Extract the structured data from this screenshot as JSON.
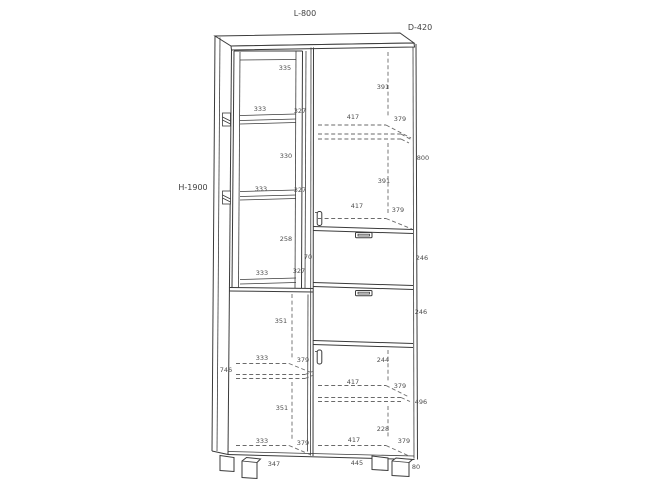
{
  "colors": {
    "line": "#3b3b3b",
    "dash": "#6a6a6a",
    "text": "#4d4d4d",
    "background": "#ffffff"
  },
  "drawing": {
    "type": "furniture cabinet technical drawing",
    "overall": {
      "width_label": "L-800",
      "depth_label": "D-420",
      "height_label": "H-1900"
    }
  },
  "dim_labels": [
    {
      "t": "335",
      "x": 285,
      "y": 68
    },
    {
      "t": "333",
      "x": 260,
      "y": 109
    },
    {
      "t": "327",
      "x": 300,
      "y": 111
    },
    {
      "t": "330",
      "x": 286,
      "y": 156
    },
    {
      "t": "333",
      "x": 261,
      "y": 189
    },
    {
      "t": "327",
      "x": 300,
      "y": 190
    },
    {
      "t": "258",
      "x": 286,
      "y": 239
    },
    {
      "t": "333",
      "x": 262,
      "y": 273
    },
    {
      "t": "327",
      "x": 299,
      "y": 271
    },
    {
      "t": "70",
      "x": 308,
      "y": 257
    },
    {
      "t": "351",
      "x": 281,
      "y": 321
    },
    {
      "t": "333",
      "x": 262,
      "y": 358
    },
    {
      "t": "379",
      "x": 303,
      "y": 360
    },
    {
      "t": "746",
      "x": 226,
      "y": 370
    },
    {
      "t": "351",
      "x": 282,
      "y": 408
    },
    {
      "t": "333",
      "x": 262,
      "y": 441
    },
    {
      "t": "379",
      "x": 303,
      "y": 443
    },
    {
      "t": "391",
      "x": 383,
      "y": 87
    },
    {
      "t": "417",
      "x": 353,
      "y": 117
    },
    {
      "t": "379",
      "x": 400,
      "y": 119
    },
    {
      "t": "800",
      "x": 423,
      "y": 158
    },
    {
      "t": "391",
      "x": 384,
      "y": 181
    },
    {
      "t": "417",
      "x": 357,
      "y": 206
    },
    {
      "t": "379",
      "x": 398,
      "y": 210
    },
    {
      "t": "246",
      "x": 422,
      "y": 258
    },
    {
      "t": "246",
      "x": 421,
      "y": 312
    },
    {
      "t": "244",
      "x": 383,
      "y": 360
    },
    {
      "t": "417",
      "x": 353,
      "y": 382
    },
    {
      "t": "379",
      "x": 400,
      "y": 386
    },
    {
      "t": "496",
      "x": 421,
      "y": 402
    },
    {
      "t": "228",
      "x": 383,
      "y": 429
    },
    {
      "t": "417",
      "x": 354,
      "y": 440
    },
    {
      "t": "379",
      "x": 404,
      "y": 441
    },
    {
      "t": "347",
      "x": 274,
      "y": 464
    },
    {
      "t": "445",
      "x": 357,
      "y": 463
    },
    {
      "t": "80",
      "x": 416,
      "y": 467
    }
  ]
}
